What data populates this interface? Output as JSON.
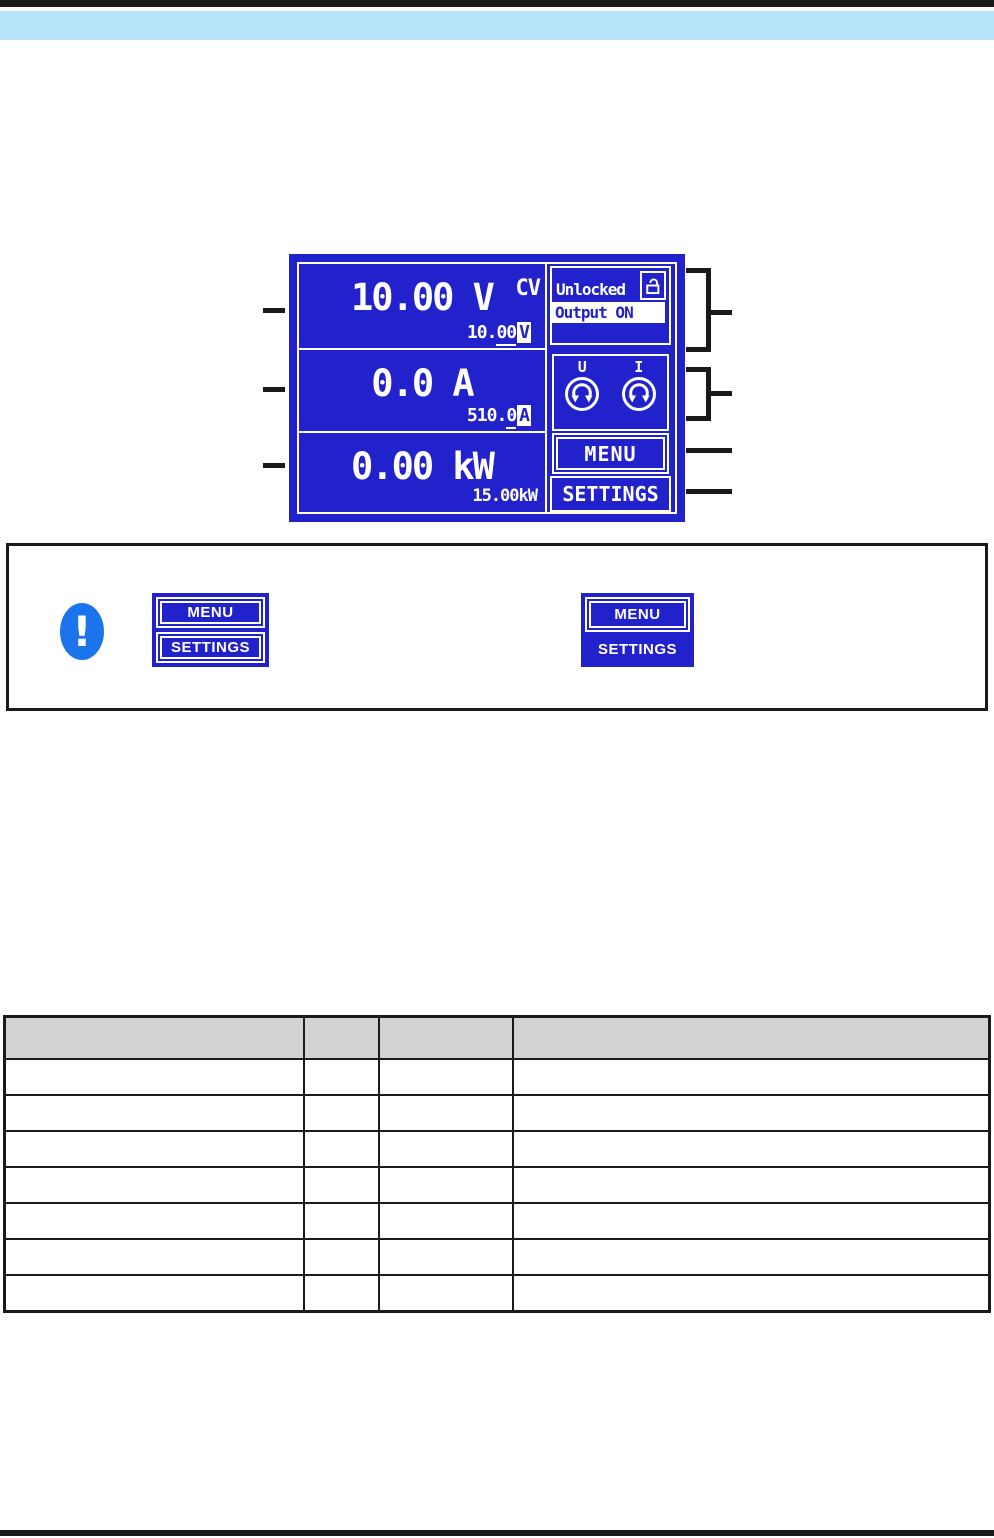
{
  "page": {
    "top_bar_color": "#1a1a1a",
    "section_bar_color": "#b6e4f9",
    "rule_color": "#1a1a1a"
  },
  "display": {
    "bg_color": "#2222cc",
    "voltage": {
      "actual": "10.00 V",
      "mode": "CV",
      "set_prefix": "10.",
      "set_underlined": "00",
      "set_unit": "V"
    },
    "current": {
      "actual": "0.0 A",
      "set_prefix": "510.",
      "set_underlined": "0",
      "set_unit": "A"
    },
    "power": {
      "actual": "0.00 kW",
      "set_value": "15.00kW"
    },
    "status": {
      "lock": "Unlocked",
      "output": "Output ON",
      "lock_icon": "open-padlock-icon"
    },
    "knobs": {
      "voltage_label": "U",
      "current_label": "I",
      "icon": "rotary-knob-icon"
    },
    "menu_button": "MENU",
    "settings_button": "SETTINGS"
  },
  "note": {
    "icon": "exclamation-icon",
    "icon_color": "#1b74ec",
    "left_group": {
      "menu": "MENU",
      "settings": "SETTINGS"
    },
    "right_group": {
      "menu": "MENU",
      "settings": "SETTINGS"
    }
  },
  "table": {
    "columns": [
      "",
      "",
      "",
      ""
    ],
    "column_widths_px": [
      300,
      76,
      134,
      478
    ],
    "rows": [
      [
        "",
        "",
        "",
        ""
      ],
      [
        "",
        "",
        "",
        ""
      ],
      [
        "",
        "",
        "",
        ""
      ],
      [
        "",
        "",
        "",
        ""
      ],
      [
        "",
        "",
        "",
        ""
      ],
      [
        "",
        "",
        "",
        ""
      ],
      [
        "",
        "",
        "",
        ""
      ]
    ]
  }
}
